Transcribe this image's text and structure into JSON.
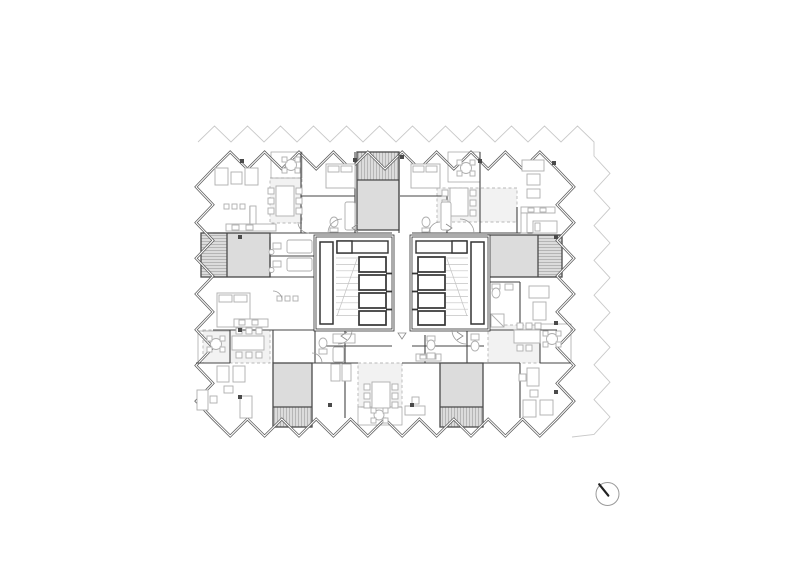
{
  "page": {
    "background": "#ffffff",
    "description": "Architectural floor plan of a residential tower typical floor with zigzag facade, no text labels"
  },
  "colors": {
    "paper": "#ffffff",
    "wall": "#454545",
    "core_wall": "#2e2e2e",
    "faint_outline": "#c9c9c9",
    "facade": "#5a5a5a",
    "furniture": "#aeaeae",
    "loggia_fill": "#dcdcdc",
    "terrace_fill": "#f2f2f2",
    "hatch_line": "#a5a5a5",
    "column_marker": "#4a4a4a",
    "north_circle": "#9a9a9a",
    "north_needle": "#222222"
  },
  "plan": {
    "type": "architectural-floor-plan",
    "facade": "zigzag sawtooth perimeter, double line",
    "offset_outline": "faint zigzag slab edge along north and east sides",
    "cores": [
      {
        "name": "core-west",
        "stair_flights": 1,
        "elevator_shafts": 4,
        "lobby": true
      },
      {
        "name": "core-east",
        "stair_flights": 1,
        "elevator_shafts": 4,
        "lobby": true
      }
    ],
    "apartments_visible": 8,
    "loggias_grey": [
      "north-center",
      "west-center",
      "east-center",
      "south-west",
      "south-east"
    ],
    "balconies_hatched": [
      "north-west",
      "north-east",
      "south-center",
      "corner-south-west",
      "corner-south-east"
    ],
    "terraces_dashed": [
      "north-west",
      "north-east",
      "south-west",
      "south-center",
      "south-east"
    ],
    "furniture": [
      "beds",
      "dining-tables-6-seats",
      "round-tables-4-seats",
      "sofas",
      "kitchens",
      "bathrooms",
      "desks",
      "wardrobes"
    ]
  },
  "north_arrow": {
    "present": true,
    "style": "circle with needle",
    "needle_points": "north-north-west"
  }
}
